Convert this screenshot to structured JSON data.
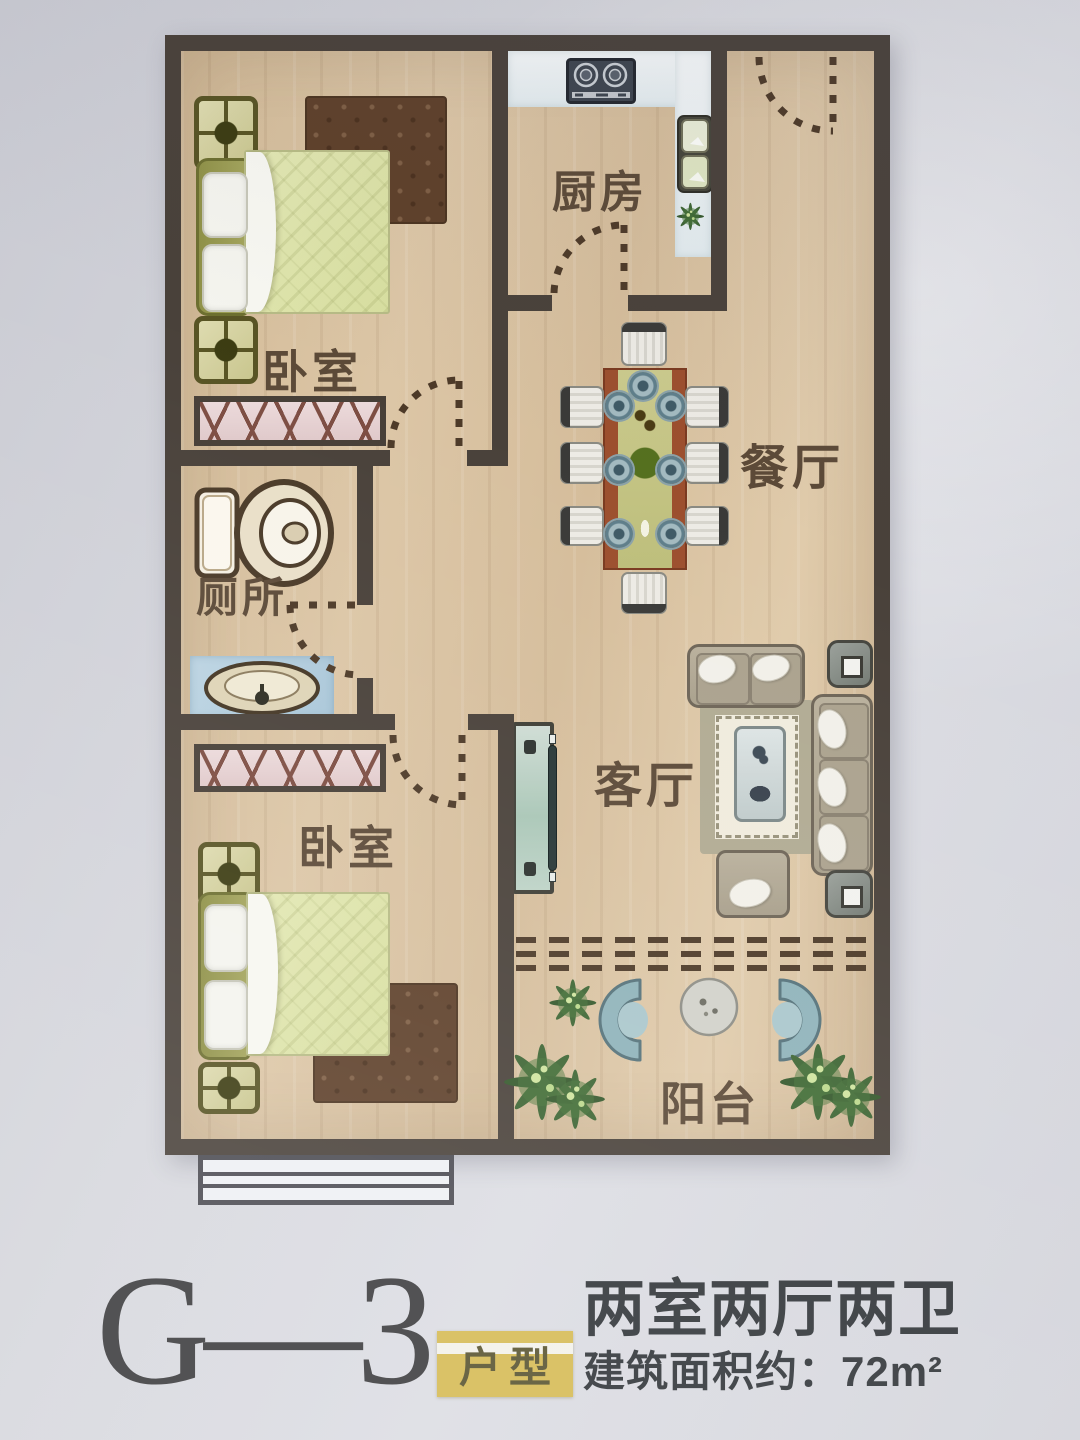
{
  "floor_plan": {
    "rooms": [
      {
        "id": "bedroom-top",
        "label": "卧室"
      },
      {
        "id": "kitchen",
        "label": "厨房"
      },
      {
        "id": "dining-room",
        "label": "餐厅"
      },
      {
        "id": "toilet",
        "label": "厕所"
      },
      {
        "id": "living-room",
        "label": "客厅"
      },
      {
        "id": "bedroom-bottom",
        "label": "卧室"
      },
      {
        "id": "balcony",
        "label": "阳台"
      }
    ],
    "colors": {
      "wall": "#49413a",
      "wood_floor": "#d8c2a2",
      "duvet_green": "#dfe4ac",
      "rug_brown": "#5e402a",
      "balcony_chair_teal": "#8fb3ba",
      "tag_yellow": "#d5ba52"
    }
  },
  "caption": {
    "unit_code": "G—3",
    "unit_tag": "户型",
    "layout_text": "两室两厅两卫",
    "area_text": "建筑面积约：72m²"
  }
}
